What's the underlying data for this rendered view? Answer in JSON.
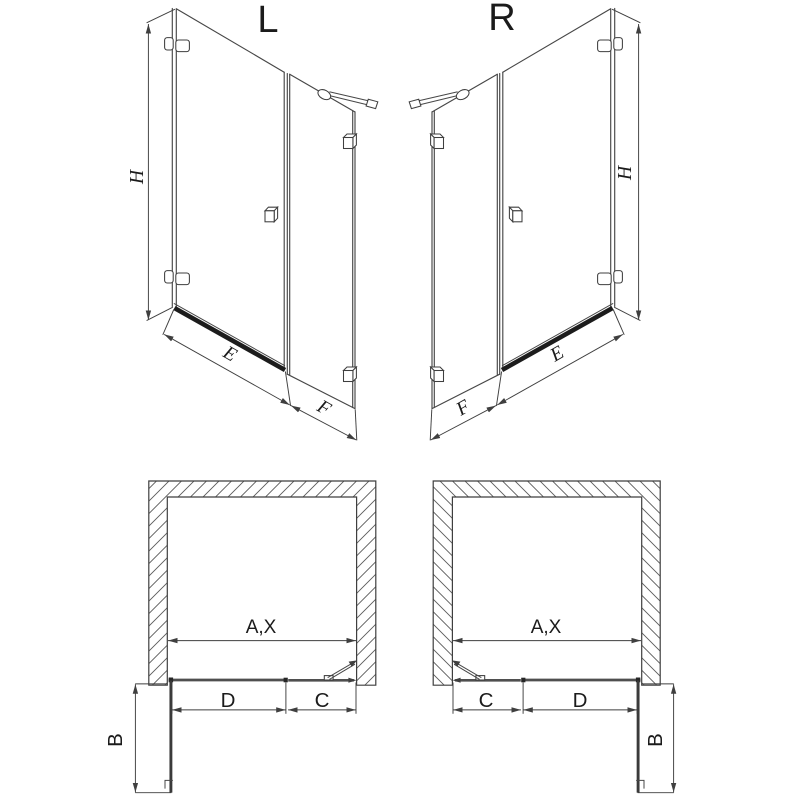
{
  "title": "Shower door technical drawing, left and right versions",
  "views": {
    "iso_left": {
      "label": "L",
      "dim_height": "H",
      "dim_door_bottom": "E",
      "dim_fixed_panel": "F"
    },
    "iso_right": {
      "label": "R",
      "dim_height": "H",
      "dim_door_bottom": "E",
      "dim_fixed_panel": "F"
    },
    "plan_left": {
      "dim_opening": "A,X",
      "dim_door": "D",
      "dim_fixed_panel": "C",
      "dim_door_open": "B"
    },
    "plan_right": {
      "dim_opening": "A,X",
      "dim_door": "D",
      "dim_fixed_panel": "C",
      "dim_door_open": "B"
    }
  },
  "colors": {
    "background": "#ffffff",
    "line": "#3f3f3f",
    "label": "#1b1b1b",
    "seal_rail": "#1c1c1c",
    "plan_glass": "#4f4f4f"
  }
}
